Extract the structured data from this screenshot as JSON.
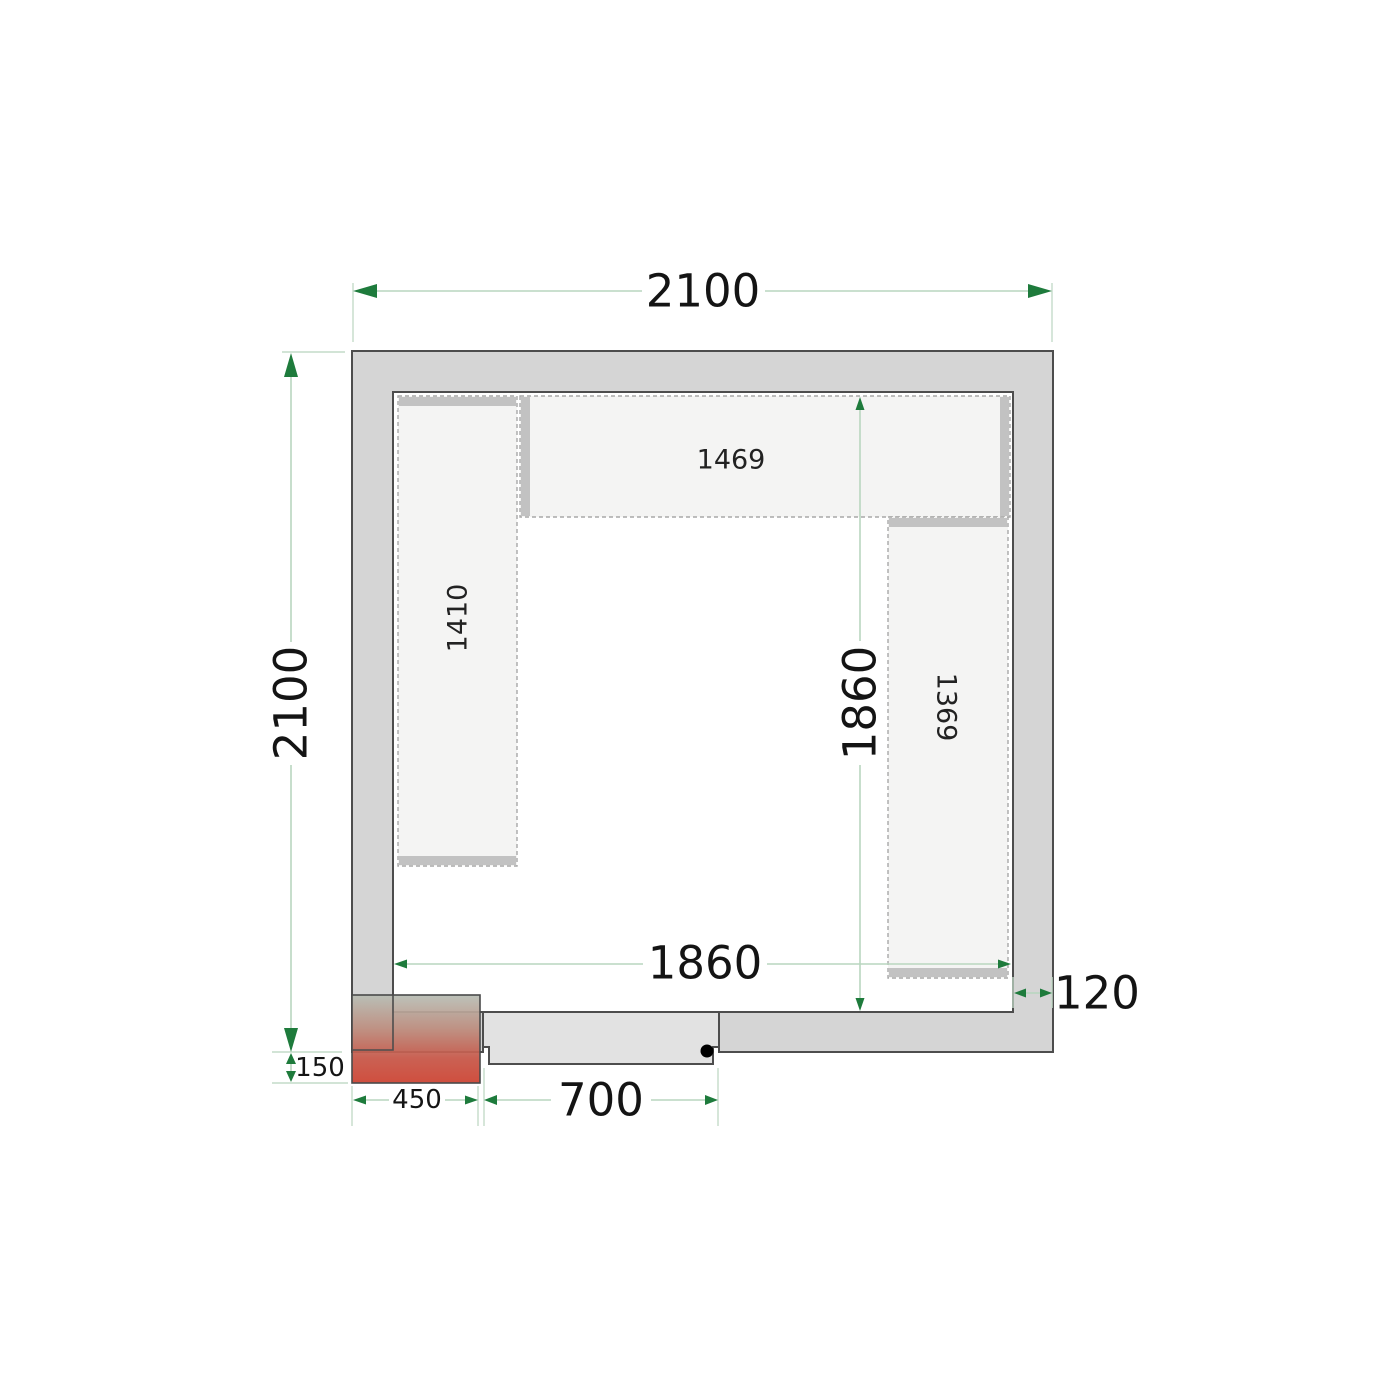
{
  "drawing": {
    "type": "cold-room-floor-plan",
    "dimensions": {
      "outer_width": "2100",
      "outer_height": "2100",
      "inner_width": "1860",
      "inner_height": "1860",
      "wall_thickness": "120",
      "door_width": "700",
      "unit_width": "450",
      "unit_offset": "150"
    },
    "shelves": {
      "left": "1410",
      "top": "1469",
      "right": "1369"
    },
    "colors": {
      "wall_fill": "#d5d5d5",
      "wall_stroke": "#4d4d4d",
      "shelf_fill": "#f4f4f3",
      "shelf_dash": "#a8a8a8",
      "shelf_cap": "#c2c2c2",
      "door_fill": "#e2e2e2",
      "dimension_line": "#b9d6bf",
      "dimension_arrow": "#1e7b3c",
      "dimension_text": "#141414",
      "unit_gradient_top": "#b7bdb4",
      "unit_gradient_bottom": "#cc4433"
    }
  }
}
